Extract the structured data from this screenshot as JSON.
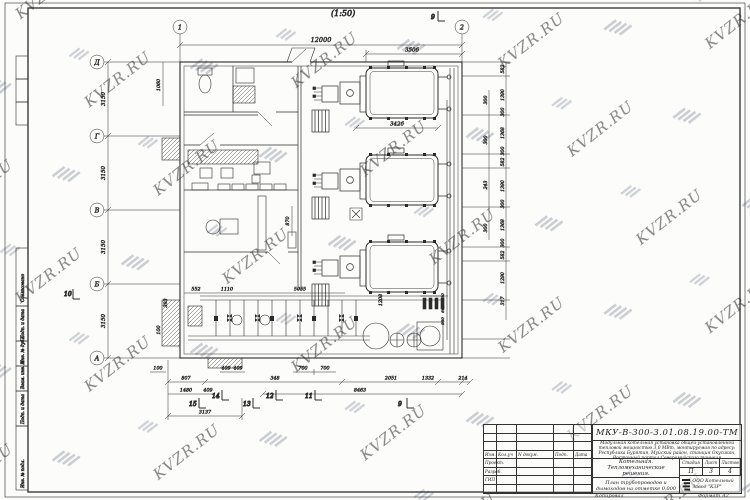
{
  "watermark": {
    "text": "KVZR.RU",
    "logo": "kvzr-stripes-logo"
  },
  "scale_label": "(1:50)",
  "axes": {
    "top": [
      "1",
      "2"
    ],
    "left": [
      "Д",
      "Г",
      "В",
      "Б",
      "А"
    ]
  },
  "dims": {
    "top": {
      "overall": "12000",
      "boiler_bay": "3506",
      "boiler_len": "3426"
    },
    "right_outer": [
      "582",
      "1390",
      "300",
      "1368",
      "300",
      "582",
      "1390",
      "300",
      "1368",
      "300",
      "582",
      "1290",
      "317"
    ],
    "right_inner": [
      "300",
      "300",
      "243",
      "300"
    ],
    "right_wall": [
      "530",
      "662",
      "980"
    ],
    "left_outer": [
      "3150",
      "3150",
      "3150",
      "3150"
    ],
    "left_misc": {
      "a": "1060",
      "b": "393",
      "c": "870",
      "d": "552",
      "e": "1110",
      "f": "5055",
      "g": "1208",
      "h": "100"
    },
    "bottom_row1": [
      "100",
      "409",
      "409",
      "700",
      "700"
    ],
    "bottom_row2": [
      "807",
      "348",
      "2051",
      "1332",
      "214"
    ],
    "bottom_row3": [
      "1480",
      "409",
      "8463"
    ],
    "bottom_row4": "3137"
  },
  "section_markers": {
    "top": "9",
    "left": "10",
    "bottom": [
      "15",
      "14",
      "13",
      "12",
      "11",
      "9"
    ]
  },
  "stamp_strip": {
    "labels": [
      "Согласовано",
      "Подп. и дата",
      "Инв. № дубл.",
      "Взам. инв. №",
      "Подп. и дата",
      "Инв. № подл."
    ]
  },
  "titleblock": {
    "doc_number": "МКУ-В-300-3.01.08.19.00-ТМ",
    "description": "Модульная котельная установка общей установленной тепловой мощностью 3,0 МВт, монтируемая по адресу: Республика Бурятия, Муйский район, станция Окусикан, Восточный портал Северомуйского тоннеля",
    "object_name": "Котельная. Тепломеханические решения.",
    "sheet_title": "План трубопроводов и дымоходов на отметке 0,000",
    "stage_label": "Стадия",
    "sheet_label": "Лист",
    "sheets_label": "Листов",
    "stage": "П",
    "sheet": "3",
    "sheets": "4",
    "company": "ООО Котельный Завод \"КЗР\"",
    "sign_rows": [
      "Проект.",
      "Разраб.",
      "ГИП"
    ],
    "sign_cols": [
      "Изм.",
      "Кол.уч",
      "N докум.",
      "Подп.",
      "Дата"
    ],
    "footer_copy": "Копировал",
    "footer_format": "Формат А2"
  }
}
